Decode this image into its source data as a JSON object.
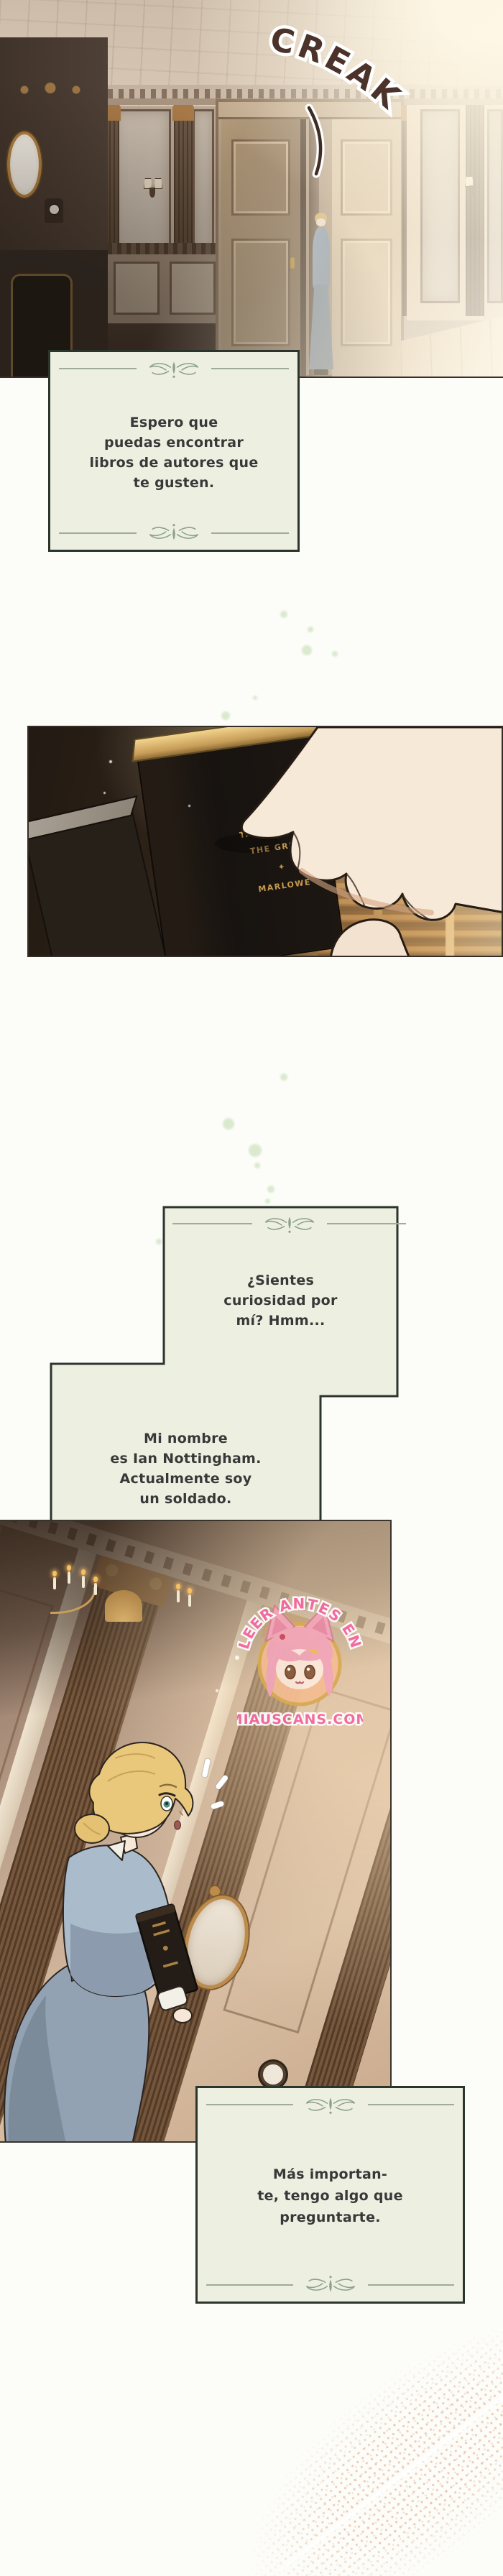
{
  "sfx": {
    "creak": "CREAK"
  },
  "speech": {
    "box1": {
      "lines": [
        "Espero que",
        "puedas encontrar",
        "libros de autores que",
        "te gusten."
      ]
    },
    "box2": {
      "lines": [
        "¿Sientes",
        "curiosidad por",
        "mí? Hmm..."
      ]
    },
    "box3": {
      "lines": [
        "Mi nombre",
        "es Ian Nottingham.",
        "Actualmente soy",
        "un soldado."
      ]
    },
    "box4": {
      "lines": [
        "Más importan-",
        "te, tengo algo que",
        "preguntarte."
      ]
    }
  },
  "book": {
    "title_line1": "TAMBURLAINE",
    "title_line2": "THE GREAT",
    "author": "MARLOWE"
  },
  "watermark": {
    "arc_text": "LEER ANTES EN",
    "site": "MIAUSCANS.COM"
  },
  "colors": {
    "box_bg": "#edefe1",
    "box_border": "#2c352c",
    "ornament_green": "#8da18c",
    "dialog_text": "#383838",
    "sfx_brown": "#4b332a",
    "watermark_pink": "#f4679f",
    "spine_gold": "#c49a4e",
    "page_bg": "#fcfdf9"
  }
}
